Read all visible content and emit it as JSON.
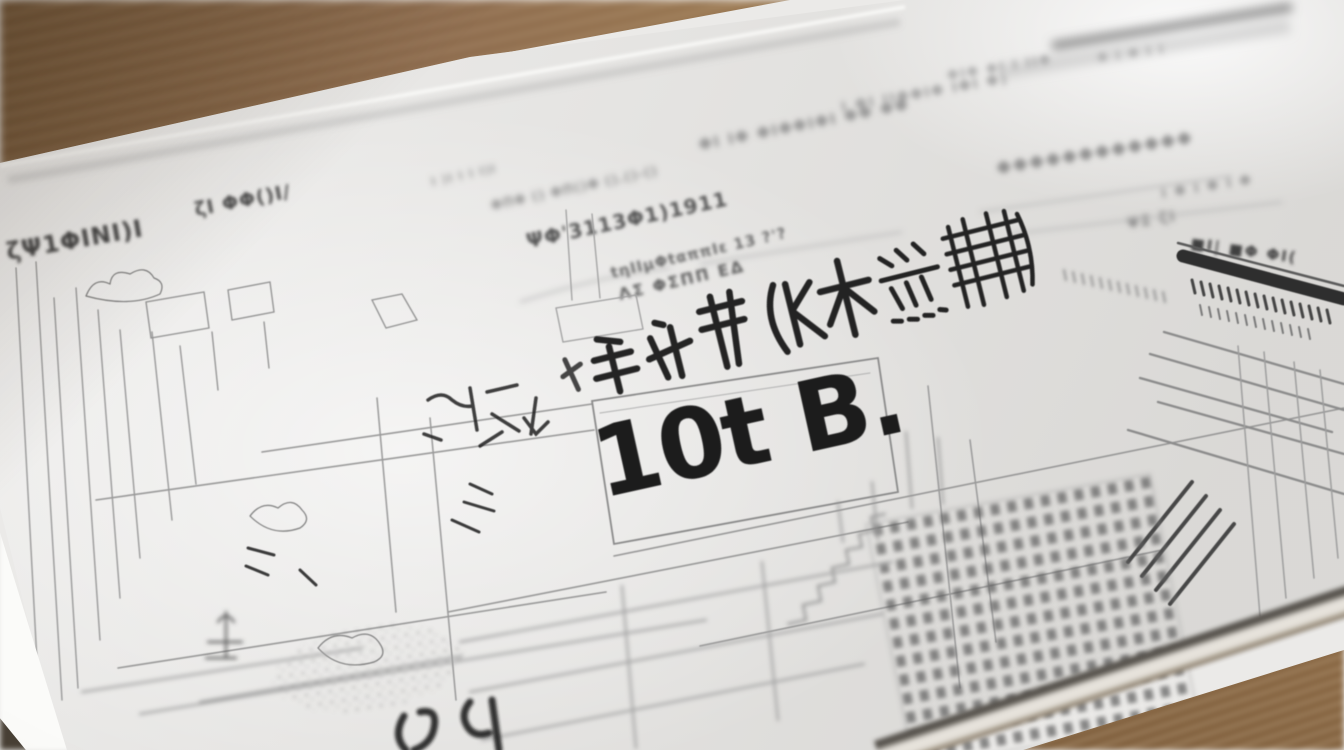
{
  "scene": {
    "description": "Angled close-up photograph of a white sketch/planning document lying on a wooden desk; blurred rows of pseudo-Japanese print recede toward the top, a bold hand-inked character row and the large annotation are in sharp focus at center, surrounded by light pencil architectural sketches; a dark table-header bar sketch sits at the right edge.",
    "focal_annotation": "10t B.",
    "colors": {
      "wood": "#9a7850",
      "wood-dark": "#6b4e30",
      "paper": "#ebeae8",
      "pencil": "#8f8f8f",
      "ink": "#1d1d1d",
      "edge-shadow": "#57534d"
    }
  },
  "glyph_runs": {
    "top_row_1": "ΦΙ ΙΦ ΦΙΦΦΙΦΙ ΦΦ ΦΦ",
    "top_row_2": "Ι ΦΙ ΙΙΦΦΙΦ ΙΦΙ Φ)",
    "top_row_3": "ΦΙΦ ΦΙ Ι ΙΙΦ",
    "top_row_4": "Φ Ι Φ Ι Ι",
    "faint_left": "Ι )Ι Ι Ι Ι)Ι",
    "left_header": "ζΨ1ΦΙΝΙ)Ι",
    "left_small": "ζΙ ΦΦ()Ι/",
    "mid_row_1": "ΦΠΦ () ΦΠ()Φ ().()-()",
    "mid_row_2": "ΨΦ'3113Φ1)1911",
    "mid_row_3": "tηΙΙμΦtαππΙε 13 ?'?",
    "mid_row_4": "ΛΣ ΦΣΠΠ ΕΔ",
    "right_blob_row": "ΦΦΦΦΦΦΦΦΦΦΦΦ",
    "right_small_1": "Ι Φ Ι Φ Ι Φ",
    "right_small_2": "ΨΣ ζΙ",
    "table_header_glyphs": "■Ι| ■Φ ΦΙ("
  }
}
